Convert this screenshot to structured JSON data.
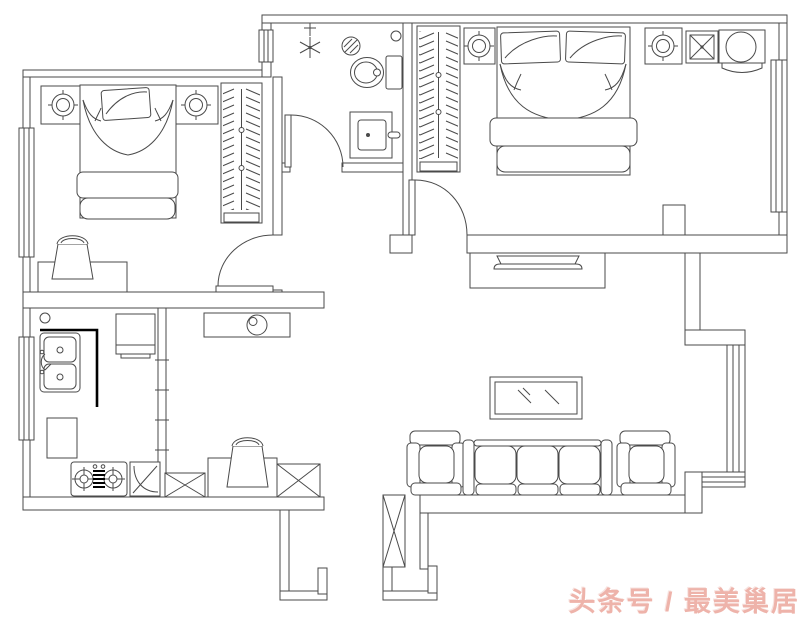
{
  "meta": {
    "type": "apartment-floor-plan",
    "style": "CAD line drawing, black lines on white"
  },
  "watermark": {
    "text": "头条号 / 最美巢居",
    "color": "#eeb3aa"
  },
  "palette": {
    "background": "#ffffff",
    "line": "#4a4a4a",
    "counter_edge": "#000000"
  },
  "rooms": [
    {
      "name": "bedroom-1",
      "position": "top-left",
      "furniture": [
        "single-bed",
        "pillow",
        "nightstand-left",
        "table-lamp",
        "nightstand-right",
        "table-lamp",
        "wardrobe-hanging-clothes",
        "desk",
        "chair",
        "window-left-wall",
        "door-swing"
      ]
    },
    {
      "name": "bathroom",
      "position": "top-middle",
      "furniture": [
        "shower-head",
        "floor-drain",
        "toilet",
        "washbasin",
        "door-swing"
      ]
    },
    {
      "name": "bedroom-2-master",
      "position": "top-right",
      "furniture": [
        "double-bed",
        "pillow-pair",
        "wardrobe-hanging-clothes",
        "nightstand-left",
        "table-lamp",
        "nightstand-right",
        "table-lamp",
        "x-stool",
        "round-chair",
        "window-right-wall",
        "door-swing"
      ]
    },
    {
      "name": "kitchen",
      "position": "bottom-left",
      "furniture": [
        "double-basin-sink",
        "counter-edge",
        "refrigerator",
        "base-cabinet",
        "gas-stove-two-burner",
        "corner-cabinet",
        "window-left-wall",
        "sliding-partition"
      ]
    },
    {
      "name": "dining-hall",
      "position": "bottom-middle",
      "furniture": [
        "shoe-cabinet-with-bowl",
        "desk",
        "chair",
        "column-x-left",
        "column-x-right",
        "entry-opening"
      ]
    },
    {
      "name": "living-room",
      "position": "bottom-right",
      "furniture": [
        "tv-cabinet",
        "tv",
        "coffee-table-glass",
        "armchair-left",
        "sofa-three-seat",
        "armchair-right",
        "corner-window",
        "column-x-tall"
      ]
    }
  ]
}
